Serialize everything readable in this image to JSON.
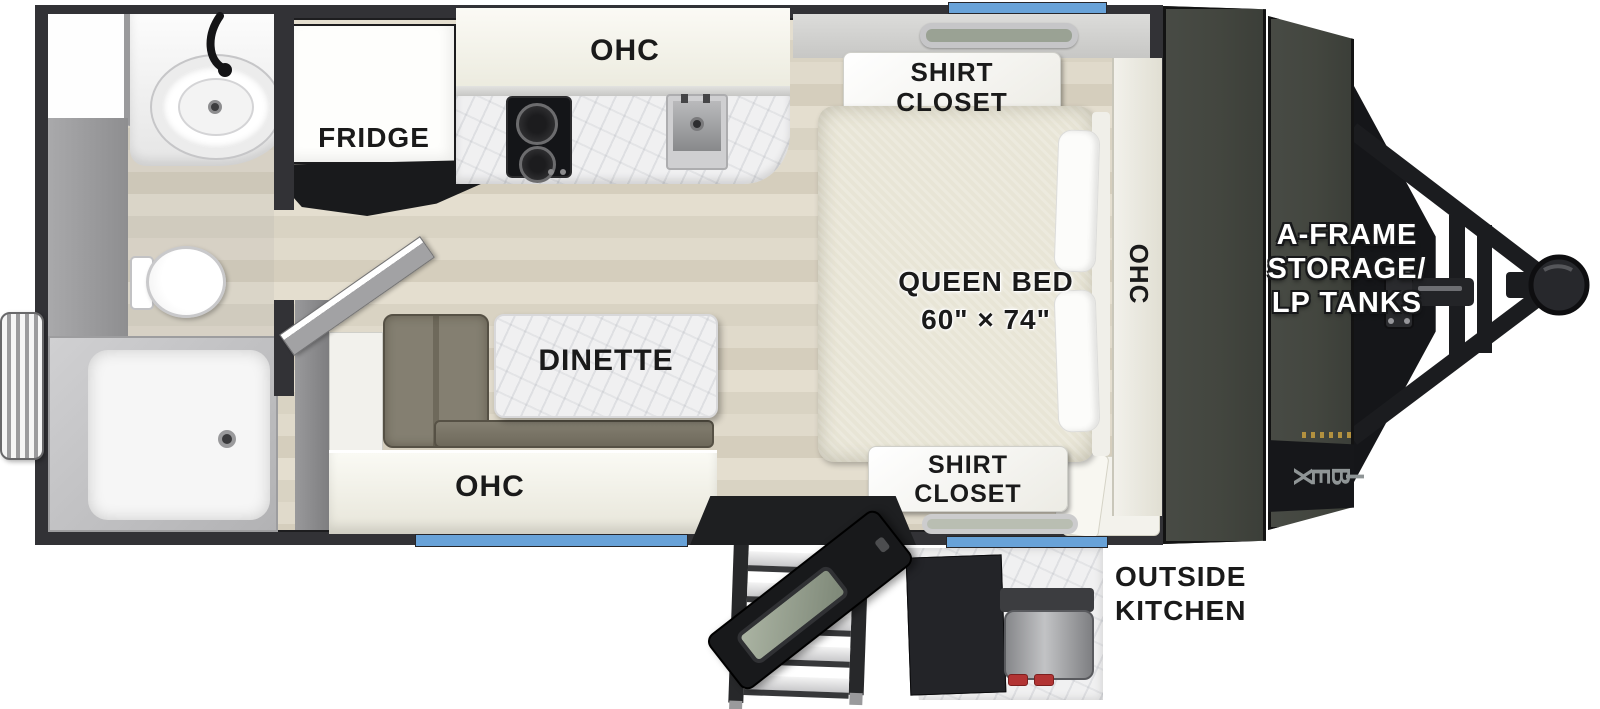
{
  "floorplan": {
    "kitchen": {
      "fridge_label": "FRIDGE",
      "ohc_label": "OHC"
    },
    "dinette": {
      "table_label": "DINETTE",
      "ohc_label": "OHC"
    },
    "bedroom": {
      "bed_label": "QUEEN BED",
      "bed_size": "60\" × 74\"",
      "ohc_label": "OHC",
      "shirt_closet_front": {
        "line1": "SHIRT",
        "line2": "CLOSET"
      },
      "shirt_closet_rear": {
        "line1": "SHIRT",
        "line2": "CLOSET"
      }
    },
    "front_storage": {
      "label_line1": "A-FRAME",
      "label_line2": "STORAGE/",
      "label_line3": "LP TANKS",
      "brand_logo": "IBEX"
    },
    "exterior": {
      "outside_kitchen_line1": "OUTSIDE",
      "outside_kitchen_line2": "KITCHEN"
    },
    "colors": {
      "window_blue": "#68a2d8",
      "wall_dark": "#323236",
      "front_panel": "#43463f",
      "bench_olive": "#7d7867",
      "knob_red": "#b23434",
      "floor_wood": "#ded8c8",
      "mattress": "#e8e5d6"
    }
  }
}
